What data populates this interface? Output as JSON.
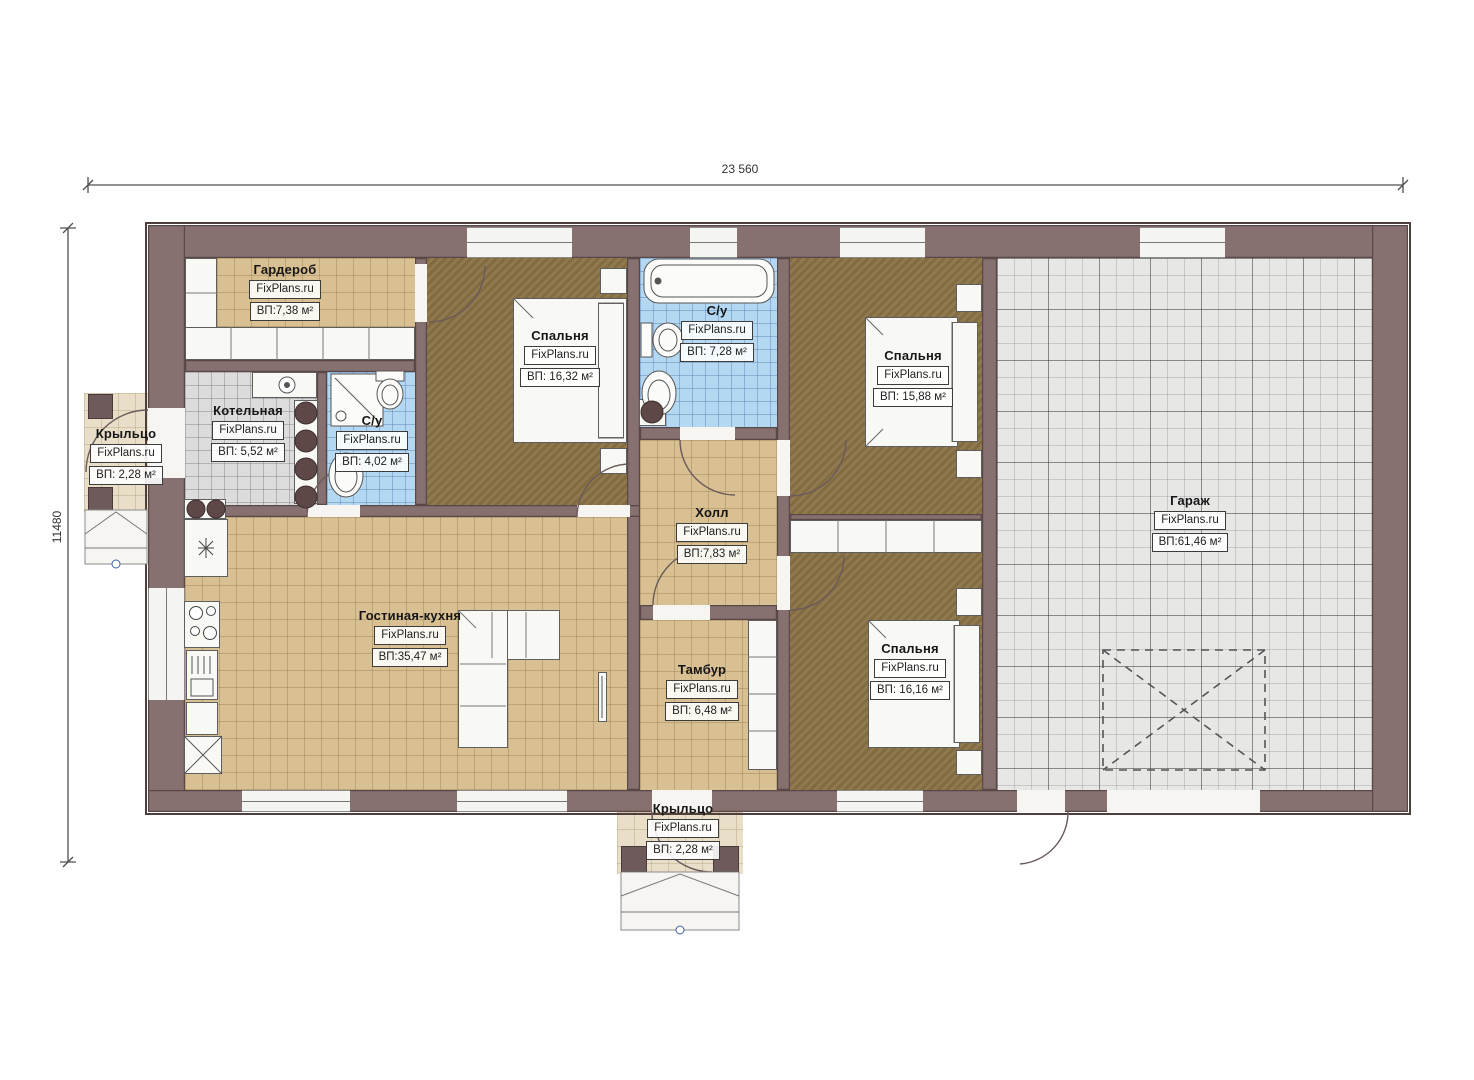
{
  "plan": {
    "brand": "FixPlans.ru",
    "dimensions": {
      "width_label": "23 560",
      "height_label": "11480"
    },
    "rooms": [
      {
        "id": "wardrobe",
        "name": "Гардероб",
        "brand": "FixPlans.ru",
        "area": "ВП:7,38 м²"
      },
      {
        "id": "bedroom-main",
        "name": "Спальня",
        "brand": "FixPlans.ru",
        "area": "ВП: 16,32 м²"
      },
      {
        "id": "bathroom-main",
        "name": "С/у",
        "brand": "FixPlans.ru",
        "area": "ВП: 7,28 м²"
      },
      {
        "id": "bedroom-right",
        "name": "Спальня",
        "brand": "FixPlans.ru",
        "area": "ВП: 15,88 м²"
      },
      {
        "id": "boiler-room",
        "name": "Котельная",
        "brand": "FixPlans.ru",
        "area": "ВП: 5,52 м²"
      },
      {
        "id": "bathroom-small",
        "name": "С/у",
        "brand": "FixPlans.ru",
        "area": "ВП: 4,02 м²"
      },
      {
        "id": "porch-left",
        "name": "Крыльцо",
        "brand": "FixPlans.ru",
        "area": "ВП: 2,28 м²"
      },
      {
        "id": "hall",
        "name": "Холл",
        "brand": "FixPlans.ru",
        "area": "ВП:7,83 м²"
      },
      {
        "id": "living-kitchen",
        "name": "Гостиная-кухня",
        "brand": "FixPlans.ru",
        "area": "ВП:35,47 м²"
      },
      {
        "id": "vestibule",
        "name": "Тамбур",
        "brand": "FixPlans.ru",
        "area": "ВП: 6,48 м²"
      },
      {
        "id": "bedroom-bottom",
        "name": "Спальня",
        "brand": "FixPlans.ru",
        "area": "ВП: 16,16 м²"
      },
      {
        "id": "garage",
        "name": "Гараж",
        "brand": "FixPlans.ru",
        "area": "ВП:61,46 м²"
      },
      {
        "id": "porch-bottom",
        "name": "Крыльцо",
        "brand": "FixPlans.ru",
        "area": "ВП: 2,28 м²"
      }
    ],
    "colors": {
      "wall": "#867070",
      "wall_edge": "#5a4848",
      "floor_tan": "#d8c092",
      "floor_brown": "#8a7245",
      "floor_blue": "#b4d8f2",
      "floor_gray": "#dcdcdc",
      "floor_garage": "#e7e7e6",
      "porch": "#e9dfc9",
      "fixture_dark": "#5d4747",
      "line": "#4f4f4f"
    }
  }
}
